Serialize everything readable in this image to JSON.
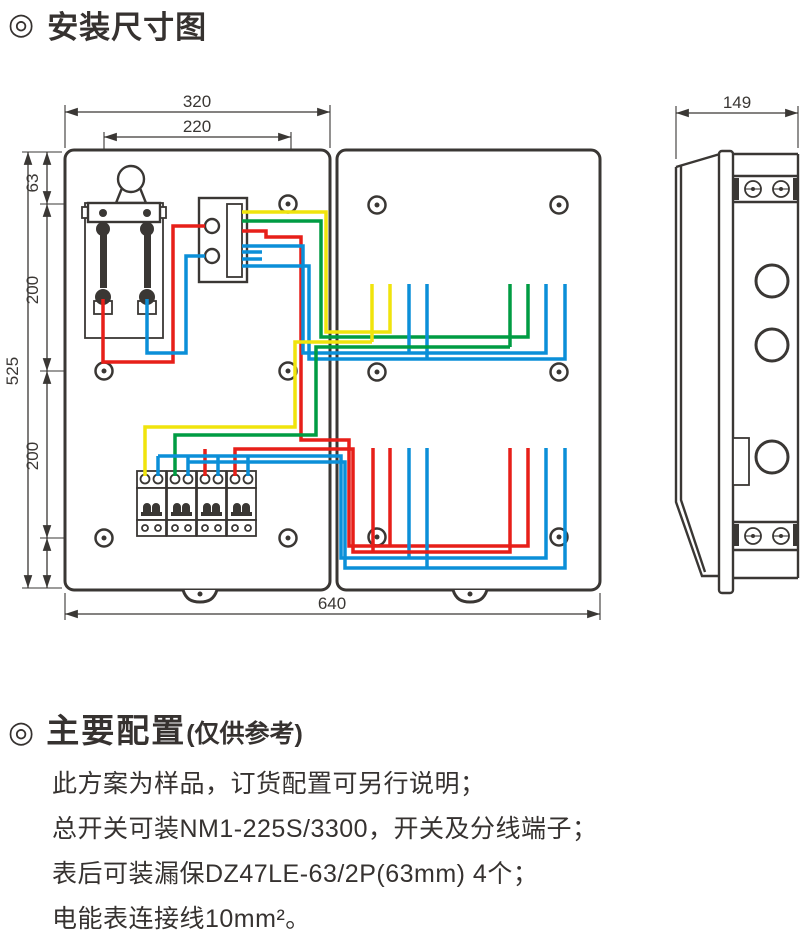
{
  "header": {
    "bullet": "◎",
    "title": "安装尺寸图"
  },
  "diagram": {
    "dimensions": {
      "front_total_width": "320",
      "mounting_hole_span": "220",
      "top_hole_offset": "63",
      "upper_hole_pitch": "200",
      "overall_height": "525",
      "lower_hole_pitch": "200",
      "overall_width": "640",
      "side_depth": "149"
    },
    "colors": {
      "outline": "#3a3734",
      "phase_yellow": "#f0e40c",
      "phase_green": "#009c43",
      "neutral_blue": "#0b8fd8",
      "phase_red": "#e71f19"
    }
  },
  "config": {
    "bullet": "◎",
    "title": "主要配置",
    "title_note": "(仅供参考)",
    "lines": [
      "此方案为样品，订货配置可另行说明；",
      "总开关可装NM1-225S/3300，开关及分线端子；",
      "表后可装漏保DZ47LE-63/2P(63mm) 4个；",
      "电能表连接线10mm²。"
    ]
  }
}
